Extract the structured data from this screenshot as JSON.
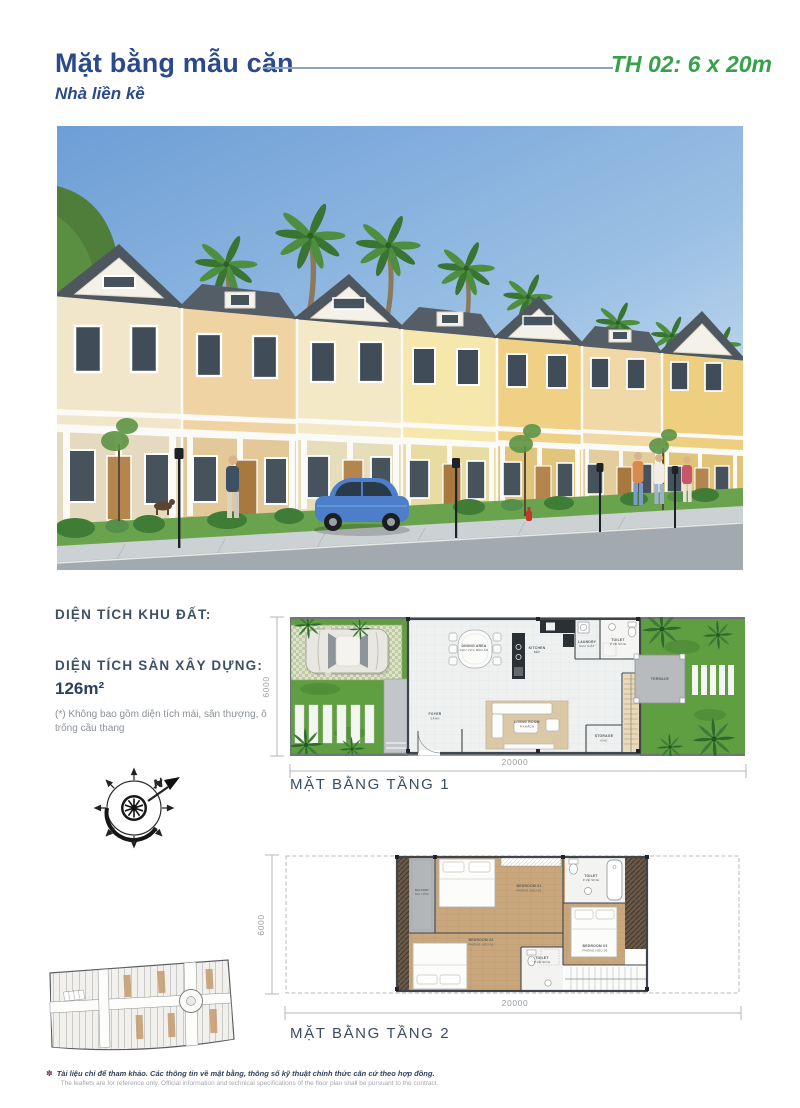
{
  "header": {
    "title": "Mặt bằng mẫu căn",
    "subtitle": "Nhà liền kề",
    "unit_type": "TH 02: 6 x 20m"
  },
  "info": {
    "land_area_label": "DIỆN TÍCH KHU ĐẤT:",
    "floor_area_label": "DIỆN TÍCH SÀN XÂY DỰNG:",
    "floor_area_value": "126m²",
    "footnote": "(*) Không bao gồm diện tích mái, sân thượng, ô trống cầu thang"
  },
  "compass": {
    "north_label": "N"
  },
  "floor1": {
    "label": "MẶT BẰNG TẦNG 1",
    "width_dim": "20000",
    "depth_dim": "6000",
    "rooms": [
      {
        "en": "DINING AREA",
        "vi": "KHU VỰC BÀN ĂN"
      },
      {
        "en": "KITCHEN",
        "vi": "BẾP"
      },
      {
        "en": "LAUNDRY",
        "vi": "KHU GIẶT"
      },
      {
        "en": "TOILET",
        "vi": "P.VỆ SINH"
      },
      {
        "en": "FOYER",
        "vi": "SẢNH"
      },
      {
        "en": "LIVING ROOM",
        "vi": "P.KHÁCH"
      },
      {
        "en": "STORAGE",
        "vi": "KHO"
      },
      {
        "en": "TERRACE",
        "vi": ""
      }
    ]
  },
  "floor2": {
    "label": "MẶT BẰNG TẦNG 2",
    "width_dim": "20000",
    "depth_dim": "6000",
    "rooms": [
      {
        "en": "BALCONY",
        "vi": "BAN CÔNG"
      },
      {
        "en": "BEDROOM 01",
        "vi": "PHÒNG NGỦ 01"
      },
      {
        "en": "TOILET",
        "vi": "P.VỆ SINH"
      },
      {
        "en": "BEDROOM 02",
        "vi": "PHÒNG NGỦ 02"
      },
      {
        "en": "TOILET",
        "vi": "P.VỆ SINH"
      },
      {
        "en": "BEDROOM 03",
        "vi": "PHÒNG NGỦ 03"
      }
    ]
  },
  "footer": {
    "disclaimer_vi": "Tài liệu chỉ để tham khảo. Các thông tin về mặt bằng, thông số kỹ thuật chính thức căn cứ theo hợp đồng.",
    "disclaimer_en": "The leaflets are for reference only. Official information and technical specifications of the floor plan shall be pursuant to the contract."
  },
  "colors": {
    "title_blue": "#2b4a8c",
    "accent_green": "#35a24a",
    "plan_label": "#3a4c63",
    "grass": "#609e42",
    "wood": "#c9a67c"
  }
}
